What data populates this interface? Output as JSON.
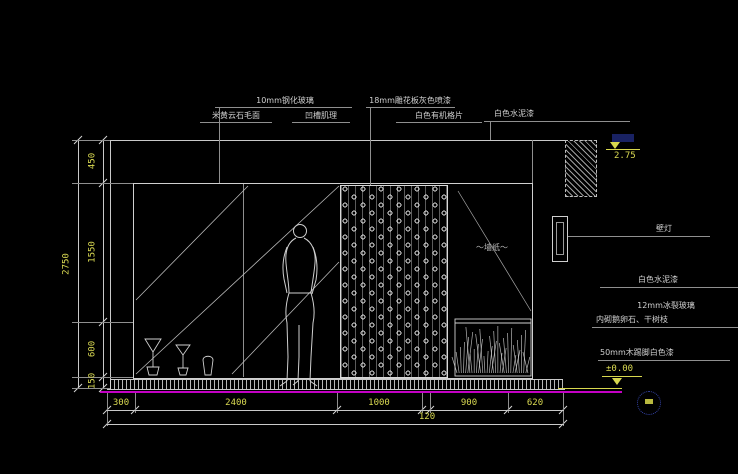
{
  "meta": {
    "drawing_type": "interior elevation CAD drawing",
    "background_color": "#000000",
    "line_color": "#c9c9c9",
    "dimension_text_color": "#dada52",
    "floor_line_color": "#c400c4"
  },
  "labels": {
    "glass": "10mm钢化玻璃",
    "marble": "米黄云石毛面",
    "groove": "凹槽肌理",
    "carved_panel": "18mm雕花板灰色喷漆",
    "white_slats": "白色有机格片",
    "cement_top": "白色水泥漆",
    "wall_lamp": "壁灯",
    "cement_right": "白色水泥漆",
    "crackle_glass": "12mm冰裂玻璃",
    "pebbles_branches": "内砌鹅卵石、干树枝",
    "skirting": "50mm木踢脚白色漆",
    "wallpaper": "～墙纸～"
  },
  "elevations": {
    "ceiling": "2.75",
    "floor": "±0.00"
  },
  "dimensions": {
    "left_overall": "2750",
    "left_segments": [
      "450",
      "1550",
      "600",
      "150"
    ],
    "bottom_segments": [
      "300",
      "2400",
      "1000",
      "900",
      "620"
    ],
    "bottom_gap": "120"
  }
}
